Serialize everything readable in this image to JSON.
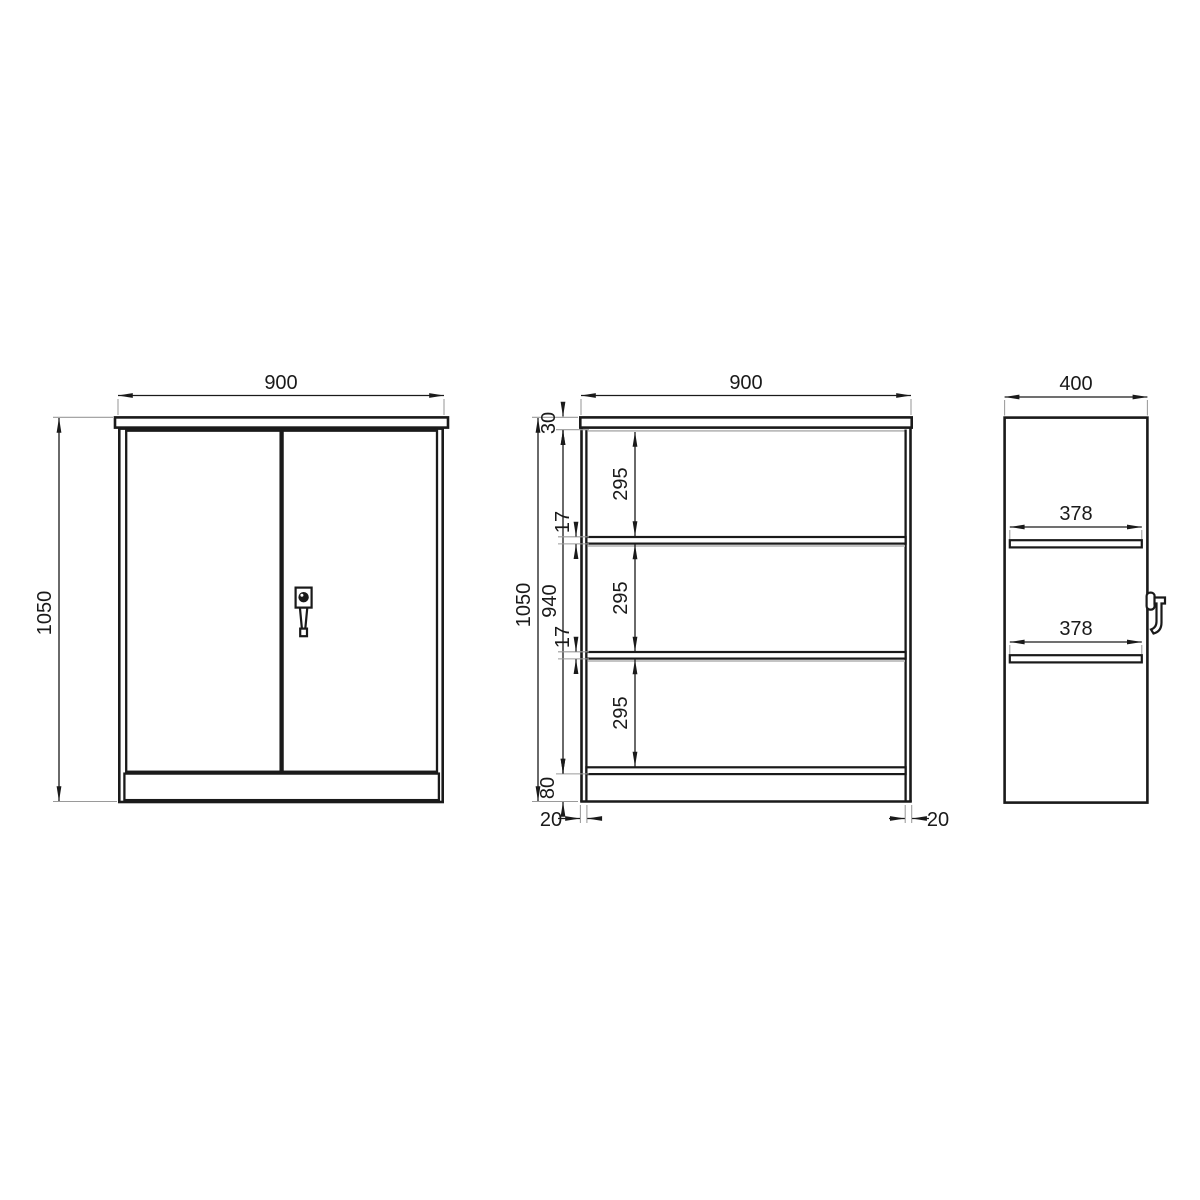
{
  "colors": {
    "background": "#ffffff",
    "line": "#1a1a1a",
    "extension_line": "#9a9a9a",
    "shadow_line": "#bcbcbc"
  },
  "views": {
    "front": {
      "width_mm": "900",
      "height_mm": "1050"
    },
    "section": {
      "width_mm": "900",
      "height_mm": "1050",
      "inner_height_mm": "940",
      "top_panel_mm": "30",
      "compartment_1_mm": "295",
      "shelf_1_mm": "17",
      "compartment_2_mm": "295",
      "shelf_2_mm": "17",
      "compartment_3_mm": "295",
      "base_mm": "80",
      "left_wall_mm": "20",
      "right_wall_mm": "20"
    },
    "side": {
      "depth_mm": "400",
      "shelf_depth_1_mm": "378",
      "shelf_depth_2_mm": "378"
    }
  }
}
